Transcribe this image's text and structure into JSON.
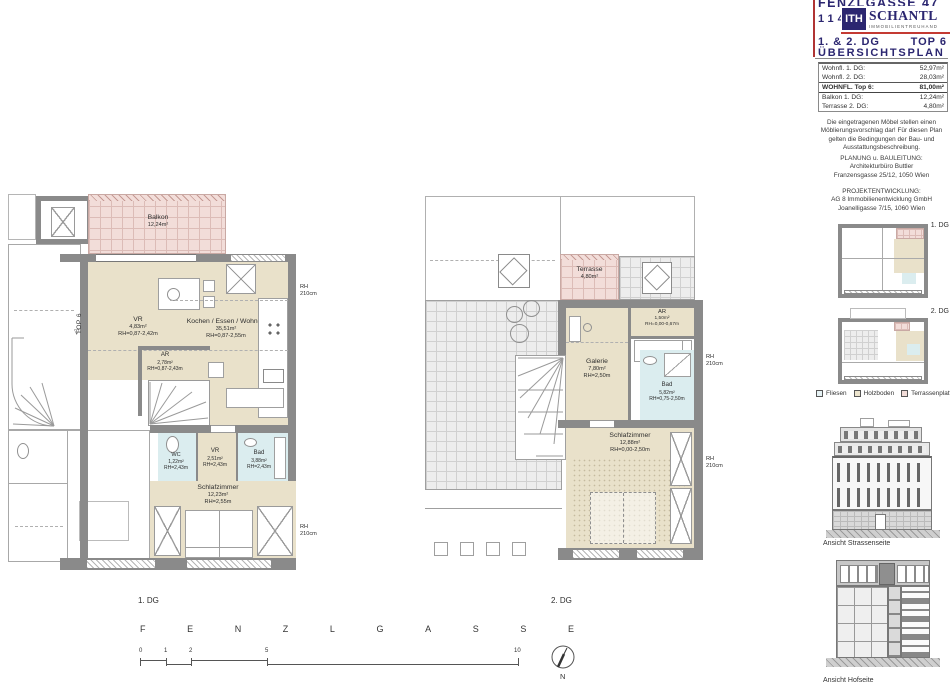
{
  "title_block": {
    "street": "FENZLGASSE 47",
    "city": "1140 WIEN",
    "logo": {
      "monogram": "ITH",
      "name": "SCHANTL",
      "tagline": "IMMOBILIENTREUHAND"
    },
    "plan_title_left": "1. & 2. DG",
    "plan_title_right": "TOP 6",
    "plan_subtitle": "ÜBERSICHTSPLAN",
    "area_table": {
      "rows": [
        {
          "label": "Wohnfl. 1. DG:",
          "value": "52,97m²"
        },
        {
          "label": "Wohnfl. 2. DG:",
          "value": "28,03m²"
        },
        {
          "label": "WOHNFL. Top 6:",
          "value": "81,00m²"
        },
        {
          "label": "Balkon 1. DG:",
          "value": "12,24m²"
        },
        {
          "label": "Terrasse 2. DG:",
          "value": "4,80m²"
        }
      ]
    },
    "disclaimer": "Die eingetragenen Möbel stellen einen Möblierungsvorschlag dar! Für diesen Plan gelten die Bedingungen der Bau- und Ausstattungsbeschreibung.",
    "planning": {
      "heading": "PLANUNG u. BAULEITUNG:",
      "line1": "Architekturbüro Buttler",
      "line2": "Franzensgasse 25/12, 1050 Wien"
    },
    "development": {
      "heading": "PROJEKTENTWICKLUNG:",
      "line1": "AG 8 Immobilienentwicklung GmbH",
      "line2": "Joanelligasse 7/15, 1060 Wien"
    },
    "mini_plan_labels": {
      "dg1": "1. DG",
      "dg2": "2. DG"
    },
    "legend": {
      "fliesen": {
        "label": "Fliesen",
        "color": "#dbedef"
      },
      "holzboden": {
        "label": "Holzboden",
        "color": "#e9e1ca"
      },
      "terrassenplatten": {
        "label": "Terrassenplatten",
        "color": "#f2ddd9"
      }
    },
    "elevation_street_caption": "Ansicht Strassenseite",
    "elevation_court_caption": "Ansicht Hofseite"
  },
  "plan1": {
    "caption": "1. DG",
    "entrance_label": "TOP 6",
    "rooms": {
      "balkon": {
        "name": "Balkon",
        "area": "12,24m²"
      },
      "vr": {
        "name": "VR",
        "area": "4,83m²",
        "rh": "RH=0,87-2,42m"
      },
      "wohnen": {
        "name": "Kochen / Essen / Wohnen",
        "area": "35,51m²",
        "rh": "RH=0,87-2,55m"
      },
      "ar": {
        "name": "AR",
        "area": "2,78m²",
        "rh": "RH=0,87-2,43m"
      },
      "wc": {
        "name": "WC",
        "area": "1,22m²",
        "rh": "RH=2,43m"
      },
      "vr2": {
        "name": "VR",
        "area": "2,51m²",
        "rh": "RH=2,43m"
      },
      "bad": {
        "name": "Bad",
        "area": "3,88m²",
        "rh": "RH=2,43m"
      },
      "schlafzimmer": {
        "name": "Schlafzimmer",
        "area": "12,23m²",
        "rh": "RH=2,55m"
      }
    },
    "rh_side_top": {
      "l1": "RH",
      "l2": "210cm"
    },
    "rh_side_bottom": {
      "l1": "RH",
      "l2": "210cm"
    }
  },
  "plan2": {
    "caption": "2. DG",
    "rooms": {
      "terrasse": {
        "name": "Terrasse",
        "area": "4,80m²"
      },
      "ar": {
        "name": "AR",
        "area": "1,50m²",
        "rh": "RH=0,00-0,67m"
      },
      "galerie": {
        "name": "Galerie",
        "area": "7,80m²",
        "rh": "RH=2,50m"
      },
      "bad": {
        "name": "Bad",
        "area": "5,82m²",
        "rh": "RH=0,75-2,50m"
      },
      "schlafzimmer": {
        "name": "Schlafzimmer",
        "area": "12,88m²",
        "rh": "RH=0,00-2,50m"
      }
    },
    "rh_side_top": {
      "l1": "RH",
      "l2": "210cm"
    },
    "rh_side_bottom": {
      "l1": "RH",
      "l2": "210cm"
    }
  },
  "street_name": {
    "letters": [
      "F",
      "E",
      "N",
      "Z",
      "L",
      "G",
      "A",
      "S",
      "S",
      "E"
    ]
  },
  "scale_bar": {
    "ticks": [
      "0",
      "1",
      "2",
      "5",
      "10"
    ]
  },
  "north_label": "N",
  "icons": {
    "entrance_arrow": "▽"
  },
  "colors": {
    "accent_navy": "#2b2670",
    "accent_red": "#c43a33",
    "wall_gray": "#8a8a8a",
    "holzboden": "#e9e1ca",
    "fliesen": "#dbedef",
    "terrasse": "#f2ddd9"
  }
}
